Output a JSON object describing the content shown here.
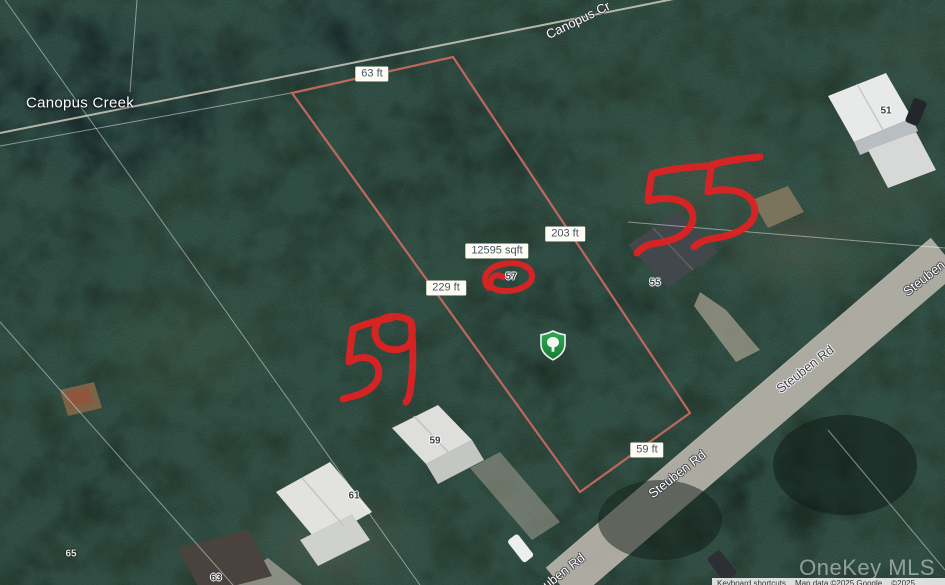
{
  "map": {
    "place_label": "Canopus Creek",
    "road_labels": [
      {
        "text": "Canopus Cr"
      },
      {
        "text": "Steuben"
      },
      {
        "text": "Steuben Rd"
      },
      {
        "text": "Steuben Rd"
      },
      {
        "text": "Steuben Rd"
      }
    ],
    "measurements": [
      {
        "text": "63 ft"
      },
      {
        "text": "203 ft"
      },
      {
        "text": "12595 sqft"
      },
      {
        "text": "229 ft"
      },
      {
        "text": "59 ft"
      }
    ],
    "house_numbers": [
      {
        "text": "51"
      },
      {
        "text": "55"
      },
      {
        "text": "57"
      },
      {
        "text": "59"
      },
      {
        "text": "61"
      },
      {
        "text": "65"
      },
      {
        "text": "63"
      }
    ],
    "annotations": {
      "freehand_55": "55",
      "freehand_59": "59",
      "circled_house_number": "57"
    },
    "marker": {
      "name": "park-shield-marker",
      "color": "#1f8b3b"
    },
    "watermark": "OneKey MLS",
    "attribution": {
      "keyboard_shortcuts": "Keyboard shortcuts",
      "map_data": "Map data ©2025 Google",
      "imagery": "©2025"
    }
  },
  "colors": {
    "parcel_outline": "#cb6a5e",
    "annotation_red": "#e32121",
    "measurement_label_bg": "#fdfbf2",
    "measurement_label_text": "#44546d",
    "road_fill": "#b3b0a7",
    "marker_green": "#1f8b3b"
  }
}
